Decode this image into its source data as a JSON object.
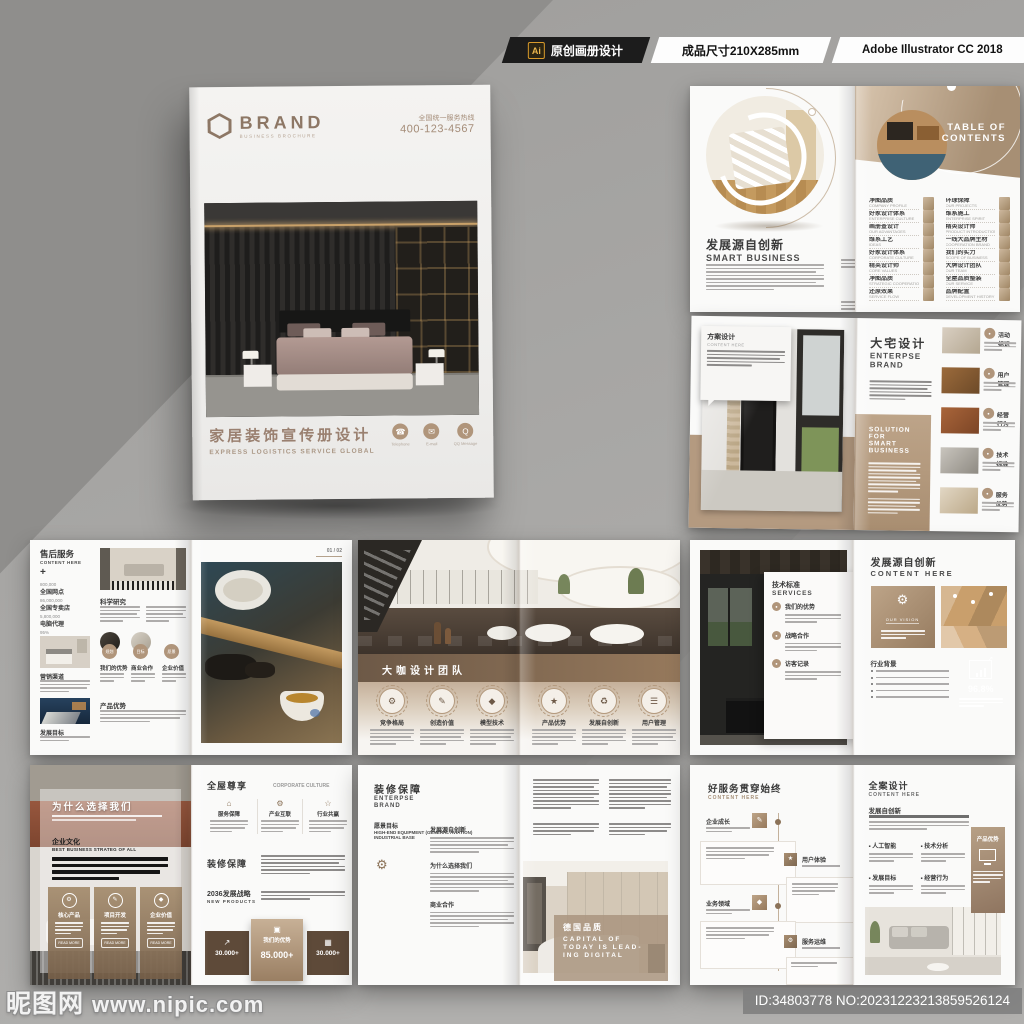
{
  "colors": {
    "accent_tan": "#b0957b",
    "accent_brown": "#6d5947",
    "title_brown": "#9a8070",
    "page_white": "#f4f3f1",
    "background_gray": "#a5a4a2"
  },
  "header": {
    "ai_badge": "Ai",
    "original_label": "原创画册设计",
    "size_label": "成品尺寸210X285mm",
    "software_label": "Adobe Illustrator CC 2018"
  },
  "watermark": {
    "site": "昵图网",
    "url": "www.nipic.com",
    "id_bar": "ID:34803778 NO:20231223213859526124"
  },
  "cover": {
    "brand": "BRAND",
    "brand_sub": "BUSINESS BROCHURE",
    "hotline_label": "全国统一服务热线",
    "hotline_number": "400-123-4567",
    "title": "家居装饰宣传册设计",
    "subtitle": "EXPRESS LOGISTICS SERVICE GLOBAL",
    "contacts": [
      {
        "label": "Telephone"
      },
      {
        "label": "E-mail"
      },
      {
        "label": "QQ Message"
      }
    ]
  },
  "spread_toc": {
    "left": {
      "title_cn": "发展源自创新",
      "title_en": "SMART BUSINESS",
      "features": [
        {
          "label": "品牌配置"
        },
        {
          "label": "愿景服务"
        }
      ]
    },
    "right": {
      "heading_line1": "TABLE OF",
      "heading_line2": "CONTENTS",
      "items_left": [
        {
          "t": "净图品质",
          "s": "COMPANY PROFILE"
        },
        {
          "t": "好家设计体系",
          "s": "ENTERPRISE CULTURE"
        },
        {
          "t": "画册查设计",
          "s": "OUR ADVANTAGES"
        },
        {
          "t": "维系工艺",
          "s": "IDEAS"
        },
        {
          "t": "好家设计体系",
          "s": "CORPORATE CULTURE"
        },
        {
          "t": "精英设计师",
          "s": "CORE VALUES"
        },
        {
          "t": "净图品质",
          "s": "STRATEGIC COOPERATION"
        },
        {
          "t": "还原效果",
          "s": "SERVICE FLOW"
        }
      ],
      "items_right": [
        {
          "t": "环球保障",
          "s": "OUR PROJECTS"
        },
        {
          "t": "维系施工",
          "s": "ENTERPRISE SPIRIT"
        },
        {
          "t": "精英设计师",
          "s": "PRODUCT INTRODUCTION"
        },
        {
          "t": "一线大品牌主材",
          "s": "COOPERATION BRAND"
        },
        {
          "t": "我们的实力",
          "s": "SCOPE OF BUSINESS"
        },
        {
          "t": "大牌设计团队",
          "s": "OUR TEAM"
        },
        {
          "t": "全屋品质整装",
          "s": "OUR SERVICE"
        },
        {
          "t": "品牌配置",
          "s": "DEVELOPMENT HISTORY"
        }
      ]
    }
  },
  "spread_brand": {
    "card": {
      "title": "方案设计",
      "sub": "CONTENT HERE"
    },
    "right": {
      "title_cn": "大宅设计",
      "title_en1": "ENTERPSE",
      "title_en2": "BRAND",
      "band_line1": "SOLUTION FOR",
      "band_line2": "SMART BUSINESS",
      "items": [
        {
          "label": "活动标识"
        },
        {
          "label": "用户管理"
        },
        {
          "label": "经营行为"
        },
        {
          "label": "技术标准"
        },
        {
          "label": "服务优势"
        }
      ]
    }
  },
  "spread_service": {
    "title_cn": "售后服务",
    "title_en": "CONTENT HERE",
    "plus": "+",
    "stats": [
      {
        "value": "800,000",
        "label": "全国网点"
      },
      {
        "value": "86,000,000",
        "label": "全国专卖店"
      },
      {
        "value": "5,800,000",
        "label": "电脑代理"
      },
      {
        "value": "95%",
        "label": "市场份额"
      }
    ],
    "photo1_label": "营销渠道",
    "photo2_label": "发展目标",
    "mid_h1": "科学研究",
    "mid_h2": "产品优势",
    "circles": [
      {
        "badge": "规划",
        "caption": "我们的优势"
      },
      {
        "badge": "目标",
        "caption": "商业合作"
      },
      {
        "badge": "愿景",
        "caption": "企业价值"
      }
    ],
    "page_no": "01 / 02"
  },
  "spread_team": {
    "band_title": "大咖设计团队",
    "members": [
      {
        "label": "竞争格局"
      },
      {
        "label": "创造价值"
      },
      {
        "label": "模型技术"
      },
      {
        "label": "产品优势"
      },
      {
        "label": "发展自创新"
      },
      {
        "label": "用户管理"
      }
    ]
  },
  "spread_innovation": {
    "card": {
      "title": "技术标准",
      "sub": "SERVICES",
      "items": [
        {
          "label": "我们的优势"
        },
        {
          "label": "战略合作"
        },
        {
          "label": "访客记录"
        }
      ]
    },
    "right": {
      "title_cn": "发展源自创新",
      "title_en": "CONTENT HERE",
      "vision": "OUR VISION",
      "industry": "行业背景",
      "percent": "96.8%"
    }
  },
  "spread_why": {
    "left": {
      "title": "为什么选择我们",
      "culture_cn": "企业文化",
      "culture_en": "BEST BUSINESS STRATEG OF ALL",
      "cards": [
        {
          "label": "核心产品"
        },
        {
          "label": "项目开发"
        },
        {
          "label": "企业价值"
        }
      ],
      "card_btn": "READ MORE"
    },
    "right": {
      "h1_cn": "全屋尊享",
      "h1_en": "CORPORATE CULTURE",
      "cols": [
        {
          "label": "服务保障"
        },
        {
          "label": "产业互联"
        },
        {
          "label": "行业共赢"
        }
      ],
      "h2": "装修保障",
      "h3_cn": "2036发展战略",
      "h3_en": "NEW PRODUCTS",
      "stat_left": "30.000+",
      "stat_center_label": "我们的优势",
      "stat_center_value": "85.000+",
      "stat_right": "30.000+"
    }
  },
  "spread_guarantee": {
    "left": {
      "title_cn": "装修保障",
      "title_en1": "ENTERPSE",
      "title_en2": "BRAND",
      "vision_cn": "愿景目标",
      "vision_en1": "HIGH-END EQUIPMENT (GENERAL AVIATION)",
      "vision_en2": "INDUSTRIAL BASE",
      "sections": [
        {
          "label": "发展源自创新"
        },
        {
          "label": "为什么选择我们"
        },
        {
          "label": "商业合作"
        }
      ]
    },
    "right": {
      "overlay_cn": "德国品质",
      "overlay_en1": "CAPITAL OF",
      "overlay_en2": "TODAY IS LEAD-",
      "overlay_en3": "ING DIGITAL"
    }
  },
  "spread_goodservice": {
    "left": {
      "title_cn": "好服务贯穿始终",
      "title_en": "CONTENT HERE",
      "timeline": [
        {
          "label": "企业成长"
        },
        {
          "label": "用户体验"
        },
        {
          "label": "业务领域"
        },
        {
          "label": "服务运维"
        }
      ]
    },
    "right": {
      "title_cn": "全案设计",
      "title_en": "CONTENT HERE",
      "h2": "发展自创新",
      "bullets": [
        {
          "label": "人工智能"
        },
        {
          "label": "技术分析"
        },
        {
          "label": "发展目标"
        },
        {
          "label": "经营行为"
        }
      ],
      "card_label": "产品优势"
    }
  }
}
